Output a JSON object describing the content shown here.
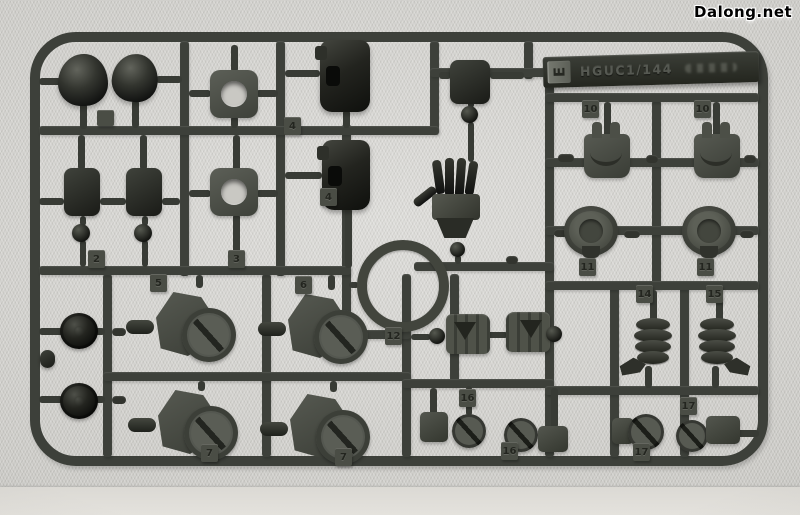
{
  "watermark": {
    "text": "Dalong.net"
  },
  "sprue": {
    "tag": {
      "letter": "E",
      "text": "HGUC1/144"
    },
    "tabs": [
      {
        "n": "2"
      },
      {
        "n": "3"
      },
      {
        "n": "4"
      },
      {
        "n": "4"
      },
      {
        "n": "5"
      },
      {
        "n": "6"
      },
      {
        "n": "7"
      },
      {
        "n": "7"
      },
      {
        "n": "10"
      },
      {
        "n": "10"
      },
      {
        "n": "11"
      },
      {
        "n": "11"
      },
      {
        "n": "12"
      },
      {
        "n": "14"
      },
      {
        "n": "15"
      },
      {
        "n": "16"
      },
      {
        "n": "16"
      },
      {
        "n": "17"
      },
      {
        "n": "17"
      }
    ]
  },
  "colors": {
    "background": "#d3d2ce",
    "floor": "#e0deda",
    "runner_plastic": "#3d403a",
    "part_gray": "#53564e",
    "part_dark_gloss": "#1d1f1a",
    "tab_face": "#4a4d45",
    "tab_numeral": "#23251f",
    "watermark_fill": "#000000",
    "watermark_outline": "#ffffff"
  }
}
